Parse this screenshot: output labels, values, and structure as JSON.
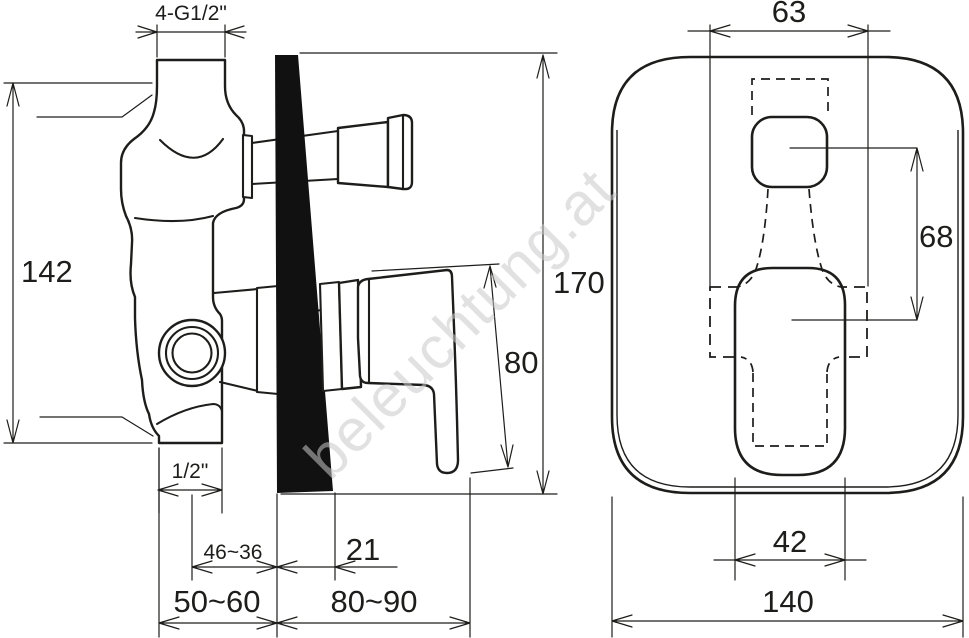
{
  "title": "Concealed shower mixer technical dimension drawing",
  "watermark": "beleuchtung.at",
  "colors": {
    "line": "#1d1d1b",
    "wall_fill": "#111111",
    "watermark": "#c9c9c9",
    "background": "#ffffff"
  },
  "left_view": {
    "dims": {
      "thread_top": "4-G1/2\"",
      "body_height": "142",
      "thread_bottom": "1/2\"",
      "depth_adjust": "46~36",
      "wall_thickness": "21",
      "rough_in_depth": "50~60",
      "front_depth": "80~90",
      "total_height": "170",
      "lever_length": "80"
    }
  },
  "front_view": {
    "dims": {
      "box_width": "63",
      "center_distance": "68",
      "lever_width": "42",
      "plate_width": "140"
    }
  }
}
